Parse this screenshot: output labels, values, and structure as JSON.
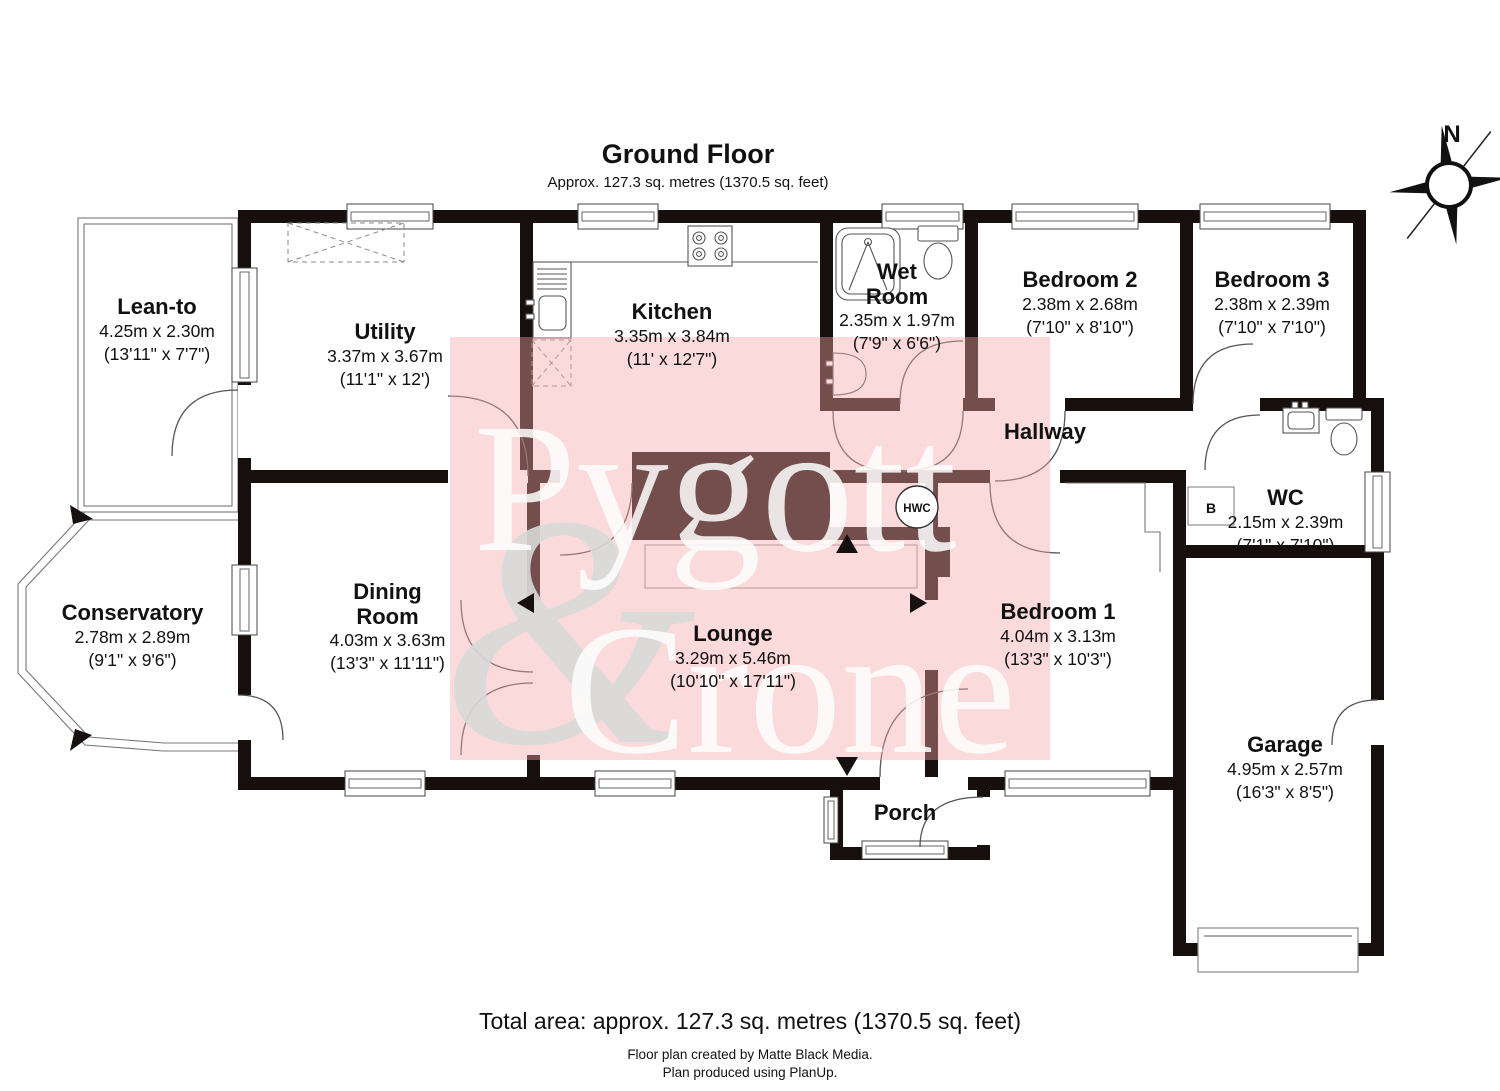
{
  "title": {
    "heading": "Ground Floor",
    "subheading": "Approx. 127.3 sq. metres (1370.5 sq. feet)"
  },
  "compass": {
    "north_label": "N"
  },
  "watermark": {
    "word1": "Pygott",
    "word2": "Crone",
    "ampersand": "&"
  },
  "rooms": {
    "leanto": {
      "name": "Lean-to",
      "metric": "4.25m x 2.30m",
      "imperial": "(13'11\" x 7'7\")"
    },
    "utility": {
      "name": "Utility",
      "metric": "3.37m x 3.67m",
      "imperial": "(11'1\" x 12')"
    },
    "kitchen": {
      "name": "Kitchen",
      "metric": "3.35m x 3.84m",
      "imperial": "(11' x 12'7\")"
    },
    "wetroom": {
      "name": "Wet Room",
      "metric": "2.35m x 1.97m",
      "imperial": "(7'9\" x 6'6\")"
    },
    "bedroom2": {
      "name": "Bedroom 2",
      "metric": "2.38m x 2.68m",
      "imperial": "(7'10\" x 8'10\")"
    },
    "bedroom3": {
      "name": "Bedroom 3",
      "metric": "2.38m x 2.39m",
      "imperial": "(7'10\" x 7'10\")"
    },
    "hallway": {
      "name": "Hallway"
    },
    "wc": {
      "name": "WC",
      "metric": "2.15m x 2.39m",
      "imperial": "(7'1\" x 7'10\")"
    },
    "conservatory": {
      "name": "Conservatory",
      "metric": "2.78m x 2.89m",
      "imperial": "(9'1\" x 9'6\")"
    },
    "dining": {
      "name": "Dining Room",
      "metric": "4.03m x 3.63m",
      "imperial": "(13'3\" x 11'11\")"
    },
    "lounge": {
      "name": "Lounge",
      "metric": "3.29m x 5.46m",
      "imperial": "(10'10\" x 17'11\")"
    },
    "bedroom1": {
      "name": "Bedroom 1",
      "metric": "4.04m x 3.13m",
      "imperial": "(13'3\" x 10'3\")"
    },
    "garage": {
      "name": "Garage",
      "metric": "4.95m x 2.57m",
      "imperial": "(16'3\" x 8'5\")"
    },
    "porch": {
      "name": "Porch"
    }
  },
  "fixtures": {
    "hwc": "HWC",
    "boiler": "B"
  },
  "footer": {
    "total": "Total area: approx. 127.3 sq. metres (1370.5 sq. feet)",
    "credit1": "Floor plan created by Matte Black Media.",
    "credit2": "Plan produced using PlanUp."
  },
  "colors": {
    "wall": "#170f0d",
    "watermark_pink": "#f2a6a6",
    "watermark_text": "#ffffff",
    "ampersand_gray": "#d9d9d9"
  }
}
